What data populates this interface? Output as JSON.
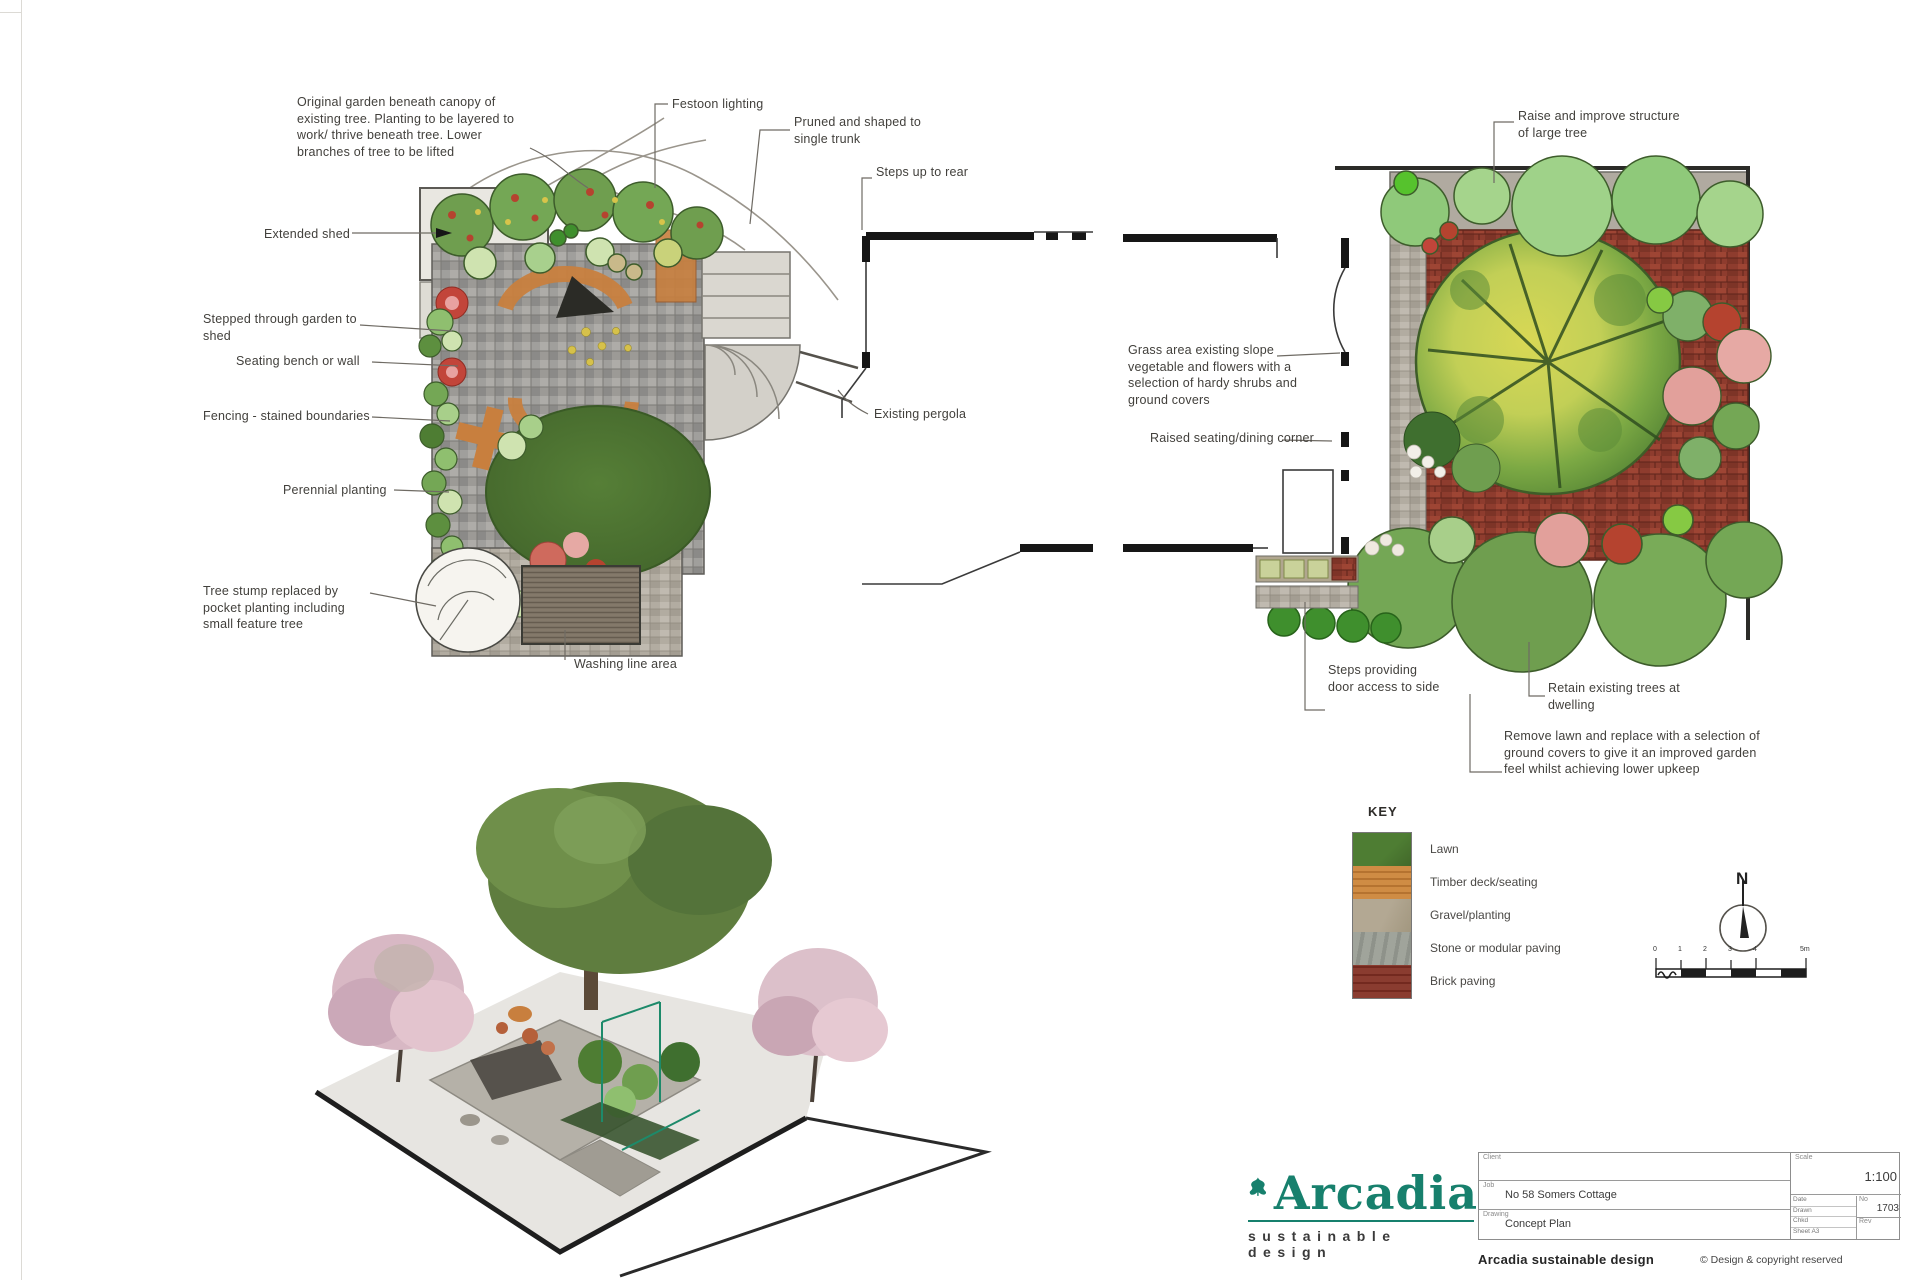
{
  "annotations": {
    "a1": "Original garden beneath canopy of existing tree. Planting to be layered to work/ thrive beneath tree. Lower branches of tree to be lifted",
    "a2": "Festoon lighting",
    "a3": "Pruned and shaped to single trunk",
    "a4": "Steps up to rear",
    "a5": "Extended shed",
    "a6": "Stepped through garden to shed",
    "a7": "Seating bench or wall",
    "a8": "Fencing - stained boundaries",
    "a9": "Perennial planting",
    "a10": "Tree stump replaced by pocket planting including small feature tree",
    "a11": "Washing line area",
    "a12": "Existing pergola",
    "b1": "Raise and improve structure of large tree",
    "b2": "Grass area existing slope vegetable and flowers with a selection of hardy shrubs and ground covers",
    "b3": "Raised seating/dining corner",
    "b4": "Steps providing door access to side",
    "b5": "Retain existing trees at dwelling",
    "b6": "Remove lawn and replace with a selection of ground covers to give it an improved garden feel whilst achieving lower upkeep"
  },
  "key": {
    "title": "KEY",
    "items": [
      {
        "label": "Lawn",
        "color": "#4e7d33"
      },
      {
        "label": "Timber deck/seating",
        "color": "#cf8c44"
      },
      {
        "label": "Gravel/planting",
        "color": "#b3a893"
      },
      {
        "label": "Stone or modular paving",
        "color": "#a0a49b"
      },
      {
        "label": "Brick paving",
        "color": "#8a3c30"
      }
    ]
  },
  "compass": {
    "label": "N"
  },
  "scalebar": {
    "ticks": [
      "0",
      "1",
      "2",
      "3",
      "4",
      "5m"
    ]
  },
  "logo": {
    "name": "Arcadia",
    "tagline": "sustainable design",
    "color": "#17806d"
  },
  "titleblock": {
    "client_label": "Client",
    "client_value": "",
    "site_label": "Job",
    "site_value": "No 58 Somers Cottage",
    "drawing_label": "Drawing",
    "drawing_value": "Concept Plan",
    "scale_label": "Scale",
    "scale_value": "1:100",
    "meta": [
      {
        "label": "Date",
        "value": ""
      },
      {
        "label": "Drawn",
        "value": ""
      },
      {
        "label": "Chkd",
        "value": ""
      },
      {
        "label": "Sheet",
        "value": "A3"
      }
    ],
    "no_label": "No",
    "no_value": "1703",
    "rev_label": "Rev",
    "rev_value": ""
  },
  "footer": {
    "left": "Arcadia sustainable design",
    "right": "© Design & copyright reserved"
  }
}
